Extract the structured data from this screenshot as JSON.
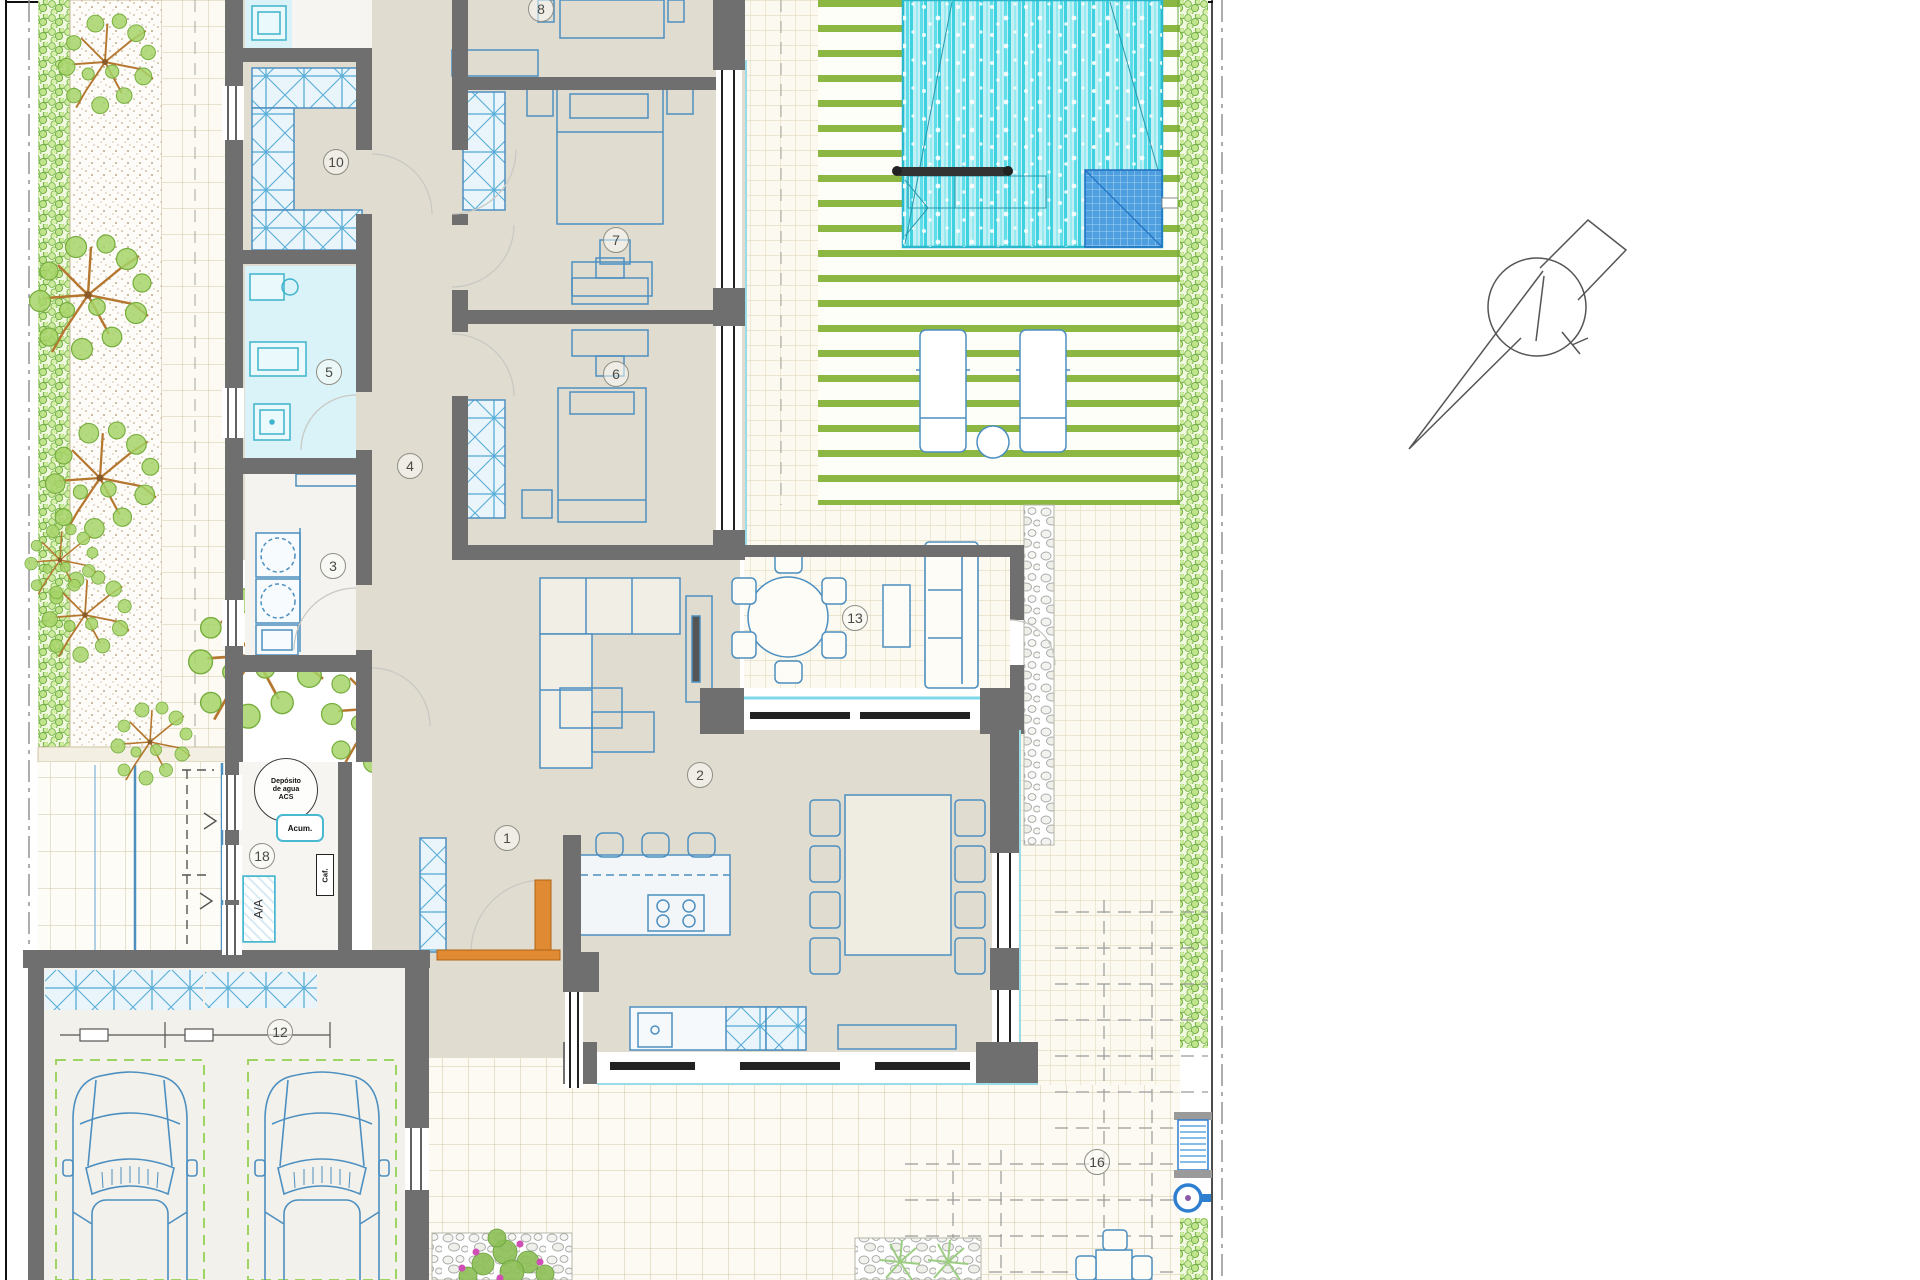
{
  "document": {
    "type": "architectural-floor-plan",
    "description": "Villa ground-floor plan with garden, swimming pool, wood deck, covered terraces and double garage"
  },
  "rooms": [
    {
      "label": "1"
    },
    {
      "label": "2"
    },
    {
      "label": "3"
    },
    {
      "label": "4"
    },
    {
      "label": "5"
    },
    {
      "label": "6"
    },
    {
      "label": "7"
    },
    {
      "label": "8"
    },
    {
      "label": "10"
    },
    {
      "label": "12"
    },
    {
      "label": "13"
    },
    {
      "label": "16"
    },
    {
      "label": "18"
    }
  ],
  "annotations": {
    "water_tank_line1": "Depósito",
    "water_tank_line2": "de agua",
    "water_tank_line3": "ACS",
    "accumulator": "Acum.",
    "air_conditioning": "A/A",
    "boiler": "Caf."
  },
  "symbols": {
    "north_arrow": "north-arrow-compass"
  },
  "colors": {
    "floor_beige": "#e0dcd0",
    "wall_gray": "#6f6f6f",
    "furniture_blue": "#4d8fc0",
    "bathroom_cyan": "#daf3f8",
    "pool_cyan": "#3ed2e0",
    "pool_steps_blue": "#1f6fc0",
    "deck_green": "#8cb742",
    "hedge_green": "#cdeb9e",
    "tree_branch_orange": "#b5772f",
    "entrance_door_orange": "#d4801f",
    "parking_dash_green": "#9ed464",
    "tile_line_tan": "#cfc5a5"
  }
}
